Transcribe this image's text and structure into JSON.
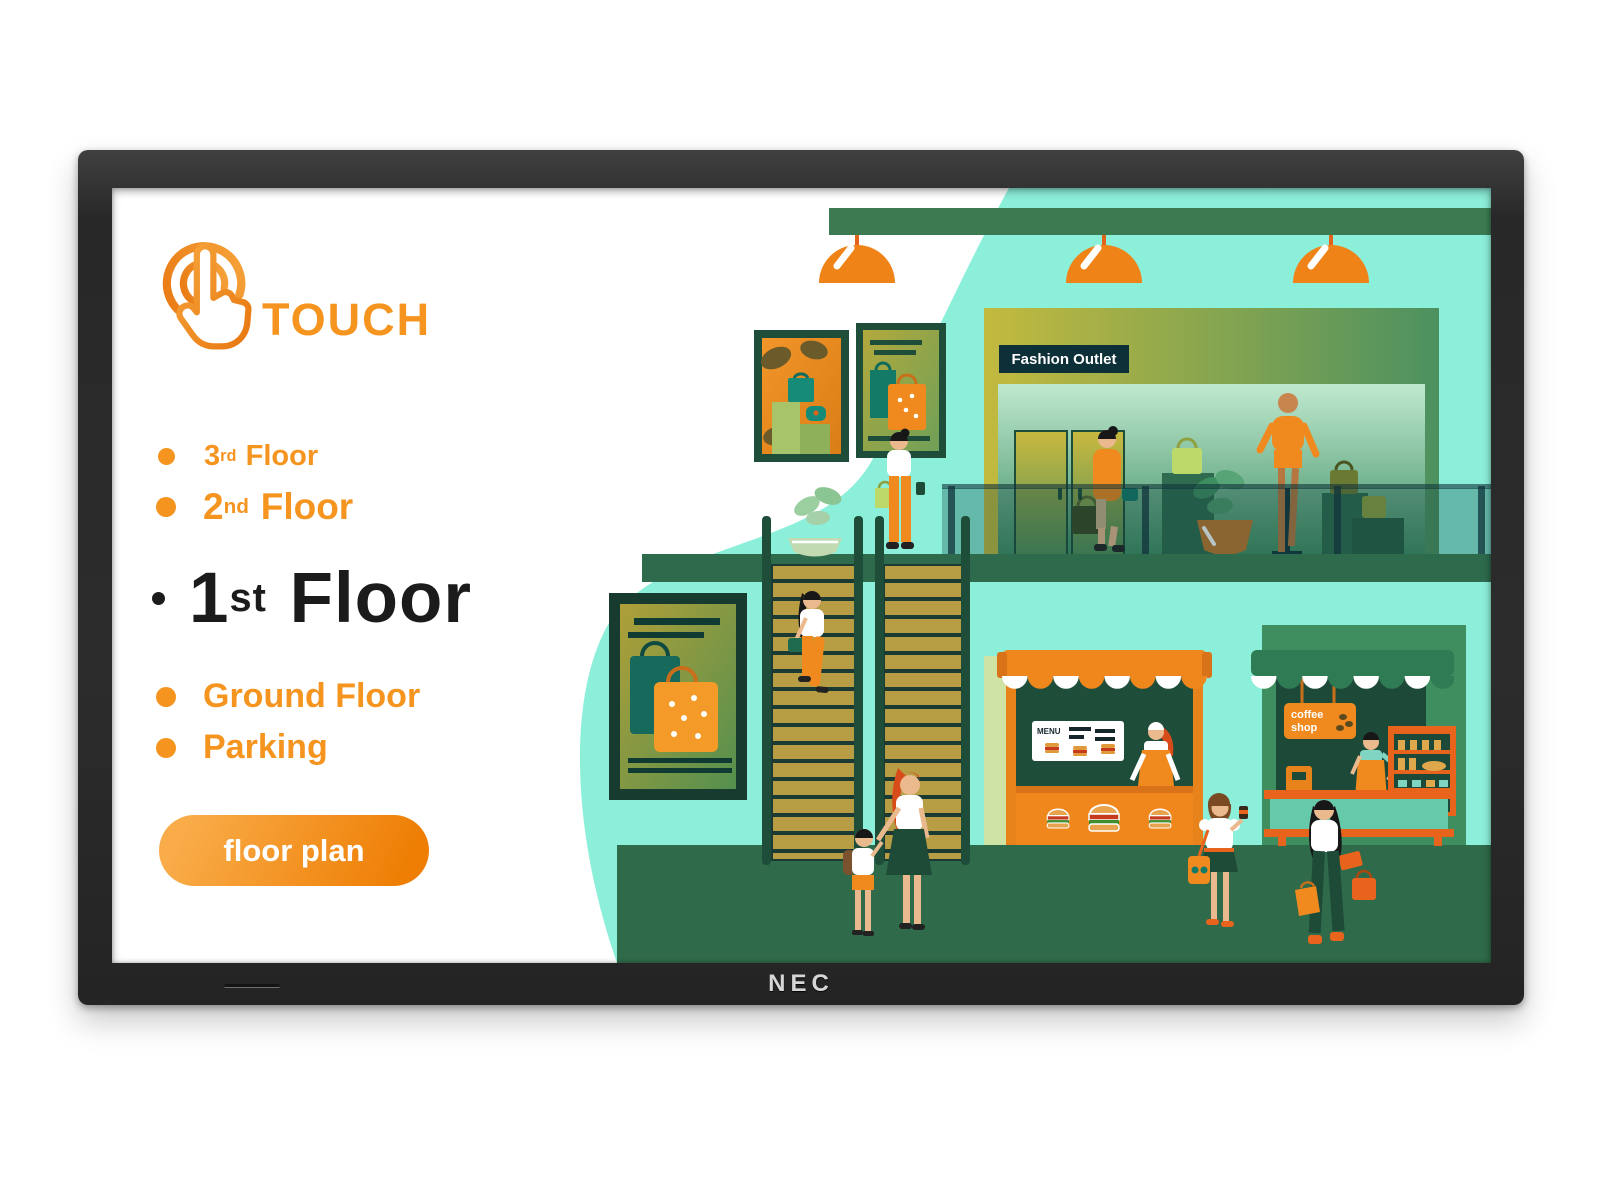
{
  "monitor": {
    "brand_label": "NEC"
  },
  "panel": {
    "touch_label": "TOUCH",
    "floors": [
      {
        "num": "3",
        "suffix": "rd",
        "name": "Floor"
      },
      {
        "num": "2",
        "suffix": "nd",
        "name": "Floor"
      },
      {
        "num": "1",
        "suffix": "st",
        "name": "Floor"
      },
      {
        "num": "",
        "suffix": "",
        "name": "Ground Floor"
      },
      {
        "num": "",
        "suffix": "",
        "name": "Parking"
      }
    ],
    "button_label": "floor plan"
  },
  "scene": {
    "store_sign": "Fashion Outlet",
    "coffee_sign_line1": "coffee",
    "coffee_sign_line2": "shop",
    "menu_title": "MENU"
  },
  "colors": {
    "accent_orange": "#F5941F",
    "awning_orange": "#F0871C",
    "mint": "#8CEFD9",
    "dark_green": "#1D4A38",
    "mid_green": "#2F6B4A",
    "bezel": "#2B2B2B"
  }
}
